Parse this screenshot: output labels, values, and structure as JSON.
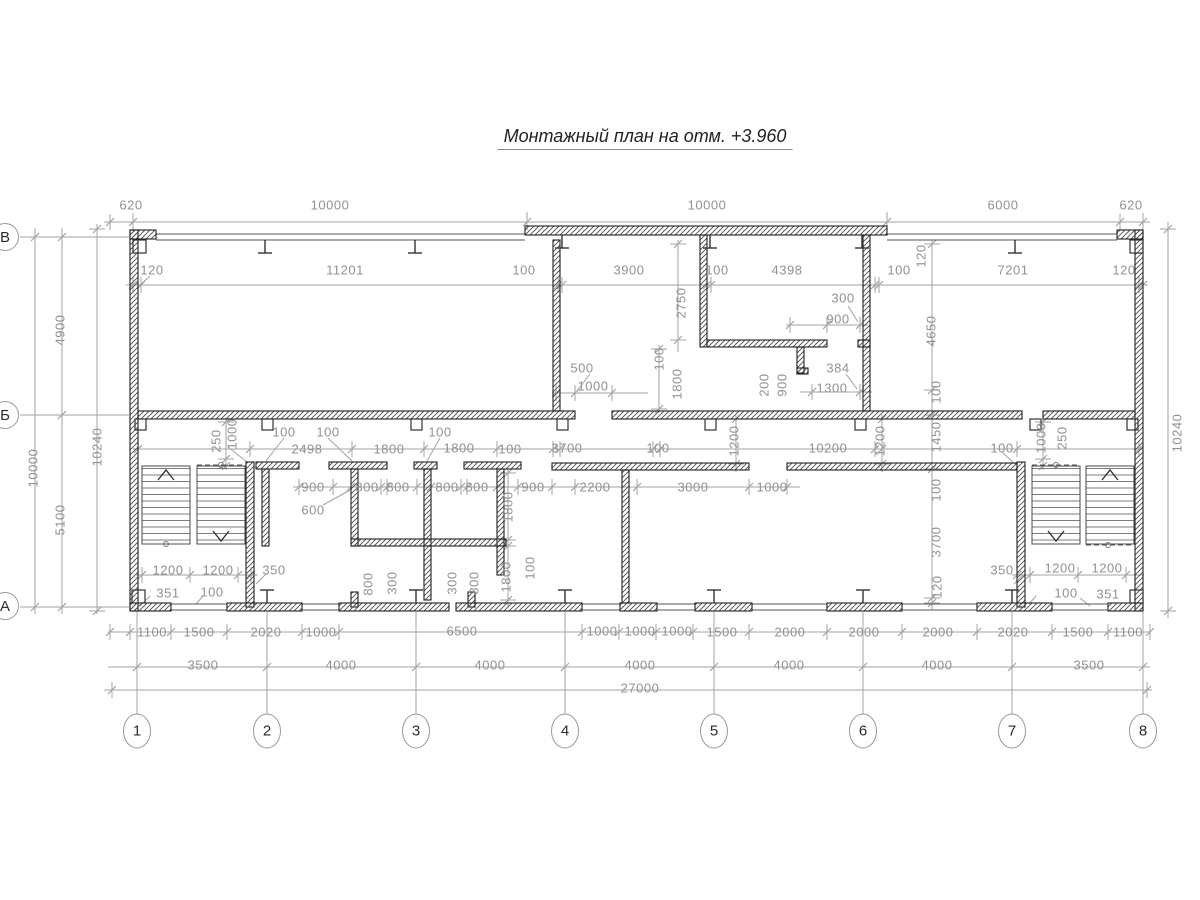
{
  "title": {
    "text": "Монтажный план на отм. +3.960"
  },
  "colors": {
    "wall": "#1f1f1f",
    "dim_line": "#a3a3a3",
    "dim_text": "#919191",
    "title_text": "#222222"
  },
  "axes": {
    "bottom": [
      {
        "label": "1",
        "x": 137
      },
      {
        "label": "2",
        "x": 267
      },
      {
        "label": "3",
        "x": 416
      },
      {
        "label": "4",
        "x": 565
      },
      {
        "label": "5",
        "x": 714
      },
      {
        "label": "6",
        "x": 863
      },
      {
        "label": "7",
        "x": 1012
      },
      {
        "label": "8",
        "x": 1143
      }
    ],
    "left": [
      {
        "label": "В",
        "y": 237
      },
      {
        "label": "Б",
        "y": 415
      },
      {
        "label": "А",
        "y": 606
      }
    ]
  },
  "labels": [
    {
      "t": "620",
      "x": 131,
      "y": 205
    },
    {
      "t": "10000",
      "x": 330,
      "y": 205
    },
    {
      "t": "10000",
      "x": 707,
      "y": 205
    },
    {
      "t": "6000",
      "x": 1003,
      "y": 205
    },
    {
      "t": "620",
      "x": 1131,
      "y": 205
    },
    {
      "t": "120",
      "x": 152,
      "y": 270
    },
    {
      "t": "11201",
      "x": 345,
      "y": 270
    },
    {
      "t": "100",
      "x": 524,
      "y": 270
    },
    {
      "t": "3900",
      "x": 629,
      "y": 270
    },
    {
      "t": "100",
      "x": 717,
      "y": 270
    },
    {
      "t": "4398",
      "x": 787,
      "y": 270
    },
    {
      "t": "100",
      "x": 899,
      "y": 270
    },
    {
      "t": "7201",
      "x": 1013,
      "y": 270
    },
    {
      "t": "120",
      "x": 1124,
      "y": 270
    },
    {
      "t": "2750",
      "x": 681,
      "y": 303,
      "r": 1
    },
    {
      "t": "120",
      "x": 921,
      "y": 256,
      "r": 1
    },
    {
      "t": "4650",
      "x": 931,
      "y": 331,
      "r": 1
    },
    {
      "t": "100",
      "x": 659,
      "y": 359,
      "r": 1
    },
    {
      "t": "1800",
      "x": 677,
      "y": 384,
      "r": 1
    },
    {
      "t": "200",
      "x": 764,
      "y": 385,
      "r": 1
    },
    {
      "t": "900",
      "x": 782,
      "y": 385,
      "r": 1
    },
    {
      "t": "300",
      "x": 843,
      "y": 298
    },
    {
      "t": "900",
      "x": 838,
      "y": 319
    },
    {
      "t": "384",
      "x": 838,
      "y": 368
    },
    {
      "t": "1300",
      "x": 832,
      "y": 388
    },
    {
      "t": "500",
      "x": 582,
      "y": 368
    },
    {
      "t": "1000",
      "x": 593,
      "y": 386
    },
    {
      "t": "4900",
      "x": 60,
      "y": 330,
      "r": 1
    },
    {
      "t": "10000",
      "x": 33,
      "y": 468,
      "r": 1
    },
    {
      "t": "10240",
      "x": 97,
      "y": 447,
      "r": 1
    },
    {
      "t": "5100",
      "x": 60,
      "y": 520,
      "r": 1
    },
    {
      "t": "10240",
      "x": 1177,
      "y": 433,
      "r": 1
    },
    {
      "t": "250",
      "x": 216,
      "y": 441,
      "r": 1
    },
    {
      "t": "1000",
      "x": 232,
      "y": 434,
      "r": 1
    },
    {
      "t": "100",
      "x": 284,
      "y": 432
    },
    {
      "t": "100",
      "x": 328,
      "y": 432
    },
    {
      "t": "2498",
      "x": 307,
      "y": 449
    },
    {
      "t": "1800",
      "x": 389,
      "y": 449
    },
    {
      "t": "100",
      "x": 440,
      "y": 432
    },
    {
      "t": "1800",
      "x": 459,
      "y": 448
    },
    {
      "t": "100",
      "x": 510,
      "y": 449
    },
    {
      "t": "3700",
      "x": 567,
      "y": 448
    },
    {
      "t": "100",
      "x": 658,
      "y": 448
    },
    {
      "t": "1200",
      "x": 734,
      "y": 441,
      "r": 1
    },
    {
      "t": "10200",
      "x": 828,
      "y": 448
    },
    {
      "t": "1200",
      "x": 880,
      "y": 441,
      "r": 1
    },
    {
      "t": "100",
      "x": 936,
      "y": 392,
      "r": 1
    },
    {
      "t": "1450",
      "x": 936,
      "y": 437,
      "r": 1
    },
    {
      "t": "100",
      "x": 936,
      "y": 490,
      "r": 1
    },
    {
      "t": "3700",
      "x": 936,
      "y": 542,
      "r": 1
    },
    {
      "t": "120",
      "x": 937,
      "y": 587,
      "r": 1
    },
    {
      "t": "100",
      "x": 1002,
      "y": 448
    },
    {
      "t": "1000",
      "x": 1041,
      "y": 438,
      "r": 1
    },
    {
      "t": "250",
      "x": 1062,
      "y": 438,
      "r": 1
    },
    {
      "t": "900",
      "x": 313,
      "y": 487
    },
    {
      "t": "800",
      "x": 367,
      "y": 487
    },
    {
      "t": "800",
      "x": 398,
      "y": 487
    },
    {
      "t": "800",
      "x": 447,
      "y": 487
    },
    {
      "t": "800",
      "x": 477,
      "y": 487
    },
    {
      "t": "900",
      "x": 533,
      "y": 487
    },
    {
      "t": "2200",
      "x": 595,
      "y": 487
    },
    {
      "t": "3000",
      "x": 693,
      "y": 487
    },
    {
      "t": "1000",
      "x": 772,
      "y": 487
    },
    {
      "t": "600",
      "x": 313,
      "y": 510
    },
    {
      "t": "1800",
      "x": 508,
      "y": 507,
      "r": 1
    },
    {
      "t": "100",
      "x": 530,
      "y": 568,
      "r": 1
    },
    {
      "t": "1800",
      "x": 506,
      "y": 577,
      "r": 1
    },
    {
      "t": "800",
      "x": 368,
      "y": 584,
      "r": 1
    },
    {
      "t": "300",
      "x": 392,
      "y": 583,
      "r": 1
    },
    {
      "t": "300",
      "x": 452,
      "y": 583,
      "r": 1
    },
    {
      "t": "800",
      "x": 474,
      "y": 583,
      "r": 1
    },
    {
      "t": "1200",
      "x": 168,
      "y": 570
    },
    {
      "t": "1200",
      "x": 218,
      "y": 570
    },
    {
      "t": "350",
      "x": 274,
      "y": 570
    },
    {
      "t": "351",
      "x": 168,
      "y": 593
    },
    {
      "t": "100",
      "x": 212,
      "y": 592
    },
    {
      "t": "350",
      "x": 1002,
      "y": 570
    },
    {
      "t": "1200",
      "x": 1060,
      "y": 568
    },
    {
      "t": "1200",
      "x": 1107,
      "y": 568
    },
    {
      "t": "100",
      "x": 1066,
      "y": 593
    },
    {
      "t": "351",
      "x": 1108,
      "y": 594
    },
    {
      "t": "1100",
      "x": 152,
      "y": 632
    },
    {
      "t": "1500",
      "x": 199,
      "y": 632
    },
    {
      "t": "2020",
      "x": 266,
      "y": 632
    },
    {
      "t": "1000",
      "x": 321,
      "y": 632
    },
    {
      "t": "6500",
      "x": 462,
      "y": 631
    },
    {
      "t": "1000",
      "x": 602,
      "y": 631
    },
    {
      "t": "1000",
      "x": 640,
      "y": 631
    },
    {
      "t": "1000",
      "x": 677,
      "y": 631
    },
    {
      "t": "1500",
      "x": 722,
      "y": 632
    },
    {
      "t": "2000",
      "x": 790,
      "y": 632
    },
    {
      "t": "2000",
      "x": 864,
      "y": 632
    },
    {
      "t": "2000",
      "x": 938,
      "y": 632
    },
    {
      "t": "2020",
      "x": 1013,
      "y": 632
    },
    {
      "t": "1500",
      "x": 1078,
      "y": 632
    },
    {
      "t": "1100",
      "x": 1128,
      "y": 632
    },
    {
      "t": "3500",
      "x": 203,
      "y": 665
    },
    {
      "t": "4000",
      "x": 341,
      "y": 665
    },
    {
      "t": "4000",
      "x": 490,
      "y": 665
    },
    {
      "t": "4000",
      "x": 640,
      "y": 665
    },
    {
      "t": "4000",
      "x": 789,
      "y": 665
    },
    {
      "t": "4000",
      "x": 937,
      "y": 665
    },
    {
      "t": "3500",
      "x": 1089,
      "y": 665
    },
    {
      "t": "27000",
      "x": 640,
      "y": 688
    }
  ]
}
